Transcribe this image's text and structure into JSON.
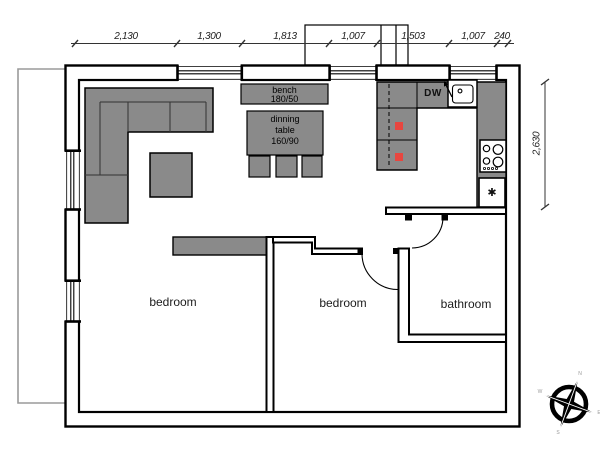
{
  "dimensions": {
    "top": [
      "2,130",
      "1,300",
      "1,813",
      "1,007",
      "1,503",
      "1,007",
      "240"
    ],
    "right": "2,630"
  },
  "rooms": {
    "bedroom_left": "bedroom",
    "bedroom_middle": "bedroom",
    "bathroom": "bathroom"
  },
  "furniture": {
    "bench_label": [
      "bench",
      "180/50"
    ],
    "dining_table_label": [
      "dinning",
      "table",
      "160/90"
    ]
  },
  "kitchen": {
    "dishwasher_label": "DW",
    "freezer_symbol": "✱"
  },
  "compass": {
    "north": "N",
    "east": "E",
    "south": "S",
    "west": "W"
  },
  "colors": {
    "furniture_gray": "#8a8a8a",
    "marker_red": "#e8463f",
    "terrace_gray": "#9a9a9a",
    "wall_black": "#000000"
  }
}
